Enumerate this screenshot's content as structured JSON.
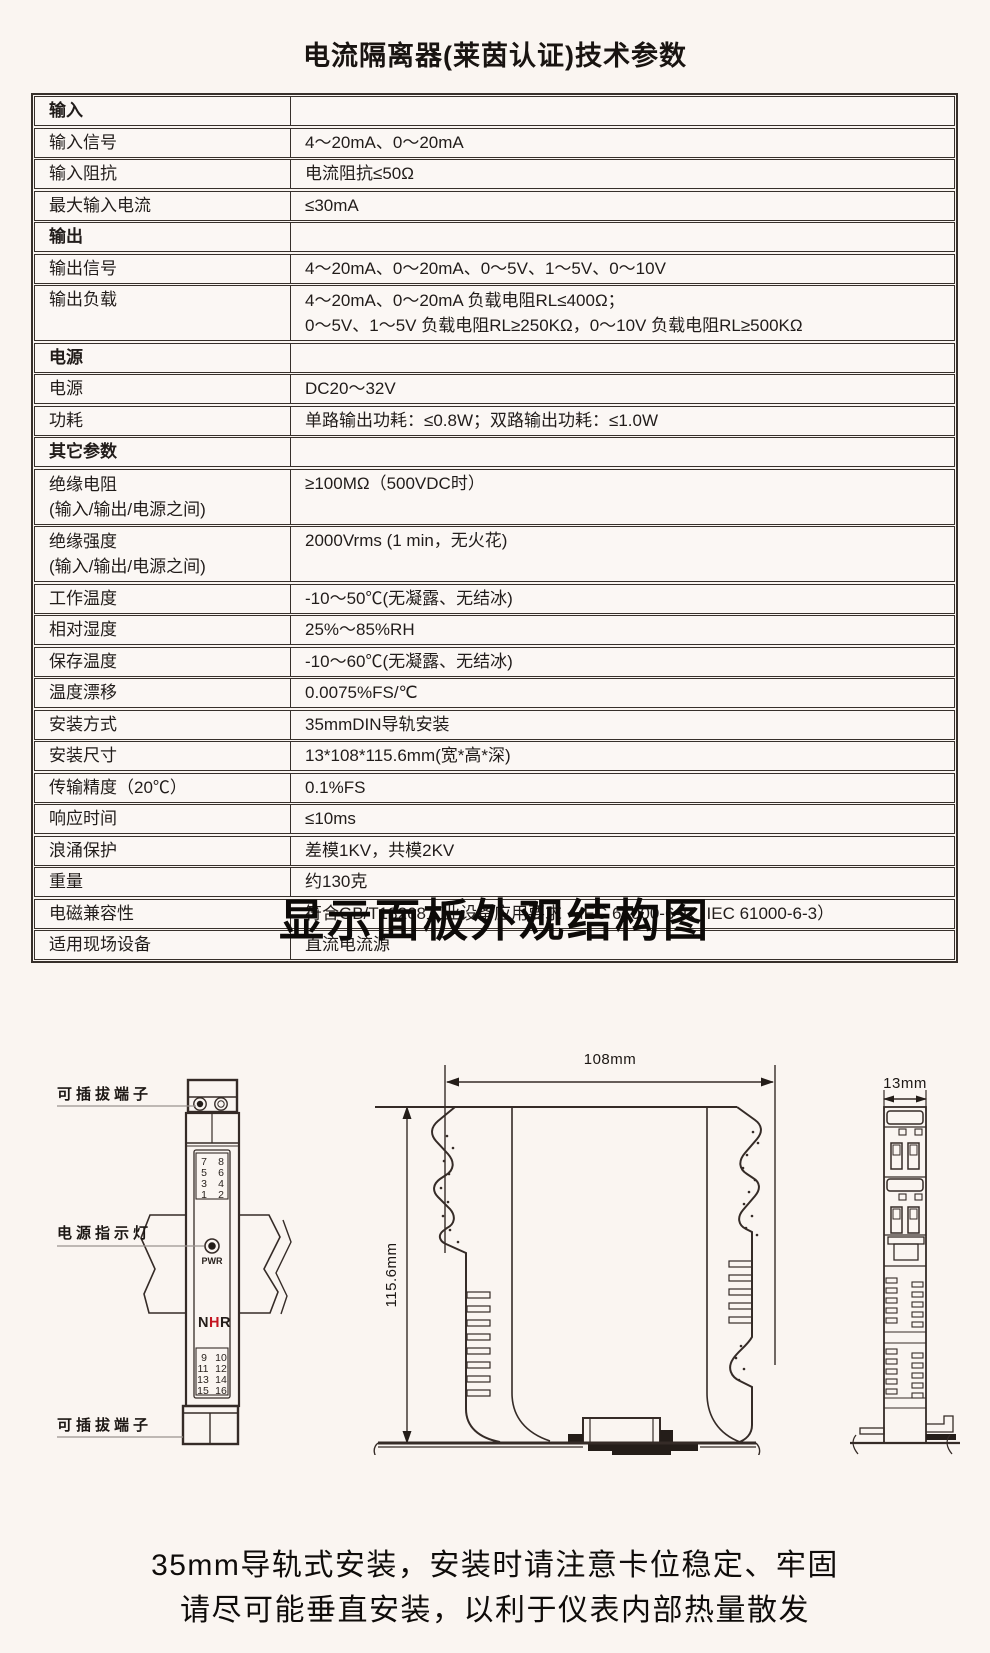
{
  "page": {
    "colors": {
      "background": "#faf5f1",
      "table_border": "#37302b",
      "drawing_line": "#352b27",
      "text": "#211c1a",
      "brand_red": "#c41420"
    }
  },
  "spec": {
    "title": "电流隔离器(莱茵认证)技术参数",
    "rows": [
      {
        "section": true,
        "label": "输入",
        "value": ""
      },
      {
        "label": "输入信号",
        "value": "4～20mA、0～20mA"
      },
      {
        "label": "输入阻抗",
        "value": "电流阻抗≤50Ω"
      },
      {
        "label": "最大输入电流",
        "value": "≤30mA"
      },
      {
        "section": true,
        "label": "输出",
        "value": ""
      },
      {
        "label": "输出信号",
        "value": "4～20mA、0～20mA、0～5V、1～5V、0～10V"
      },
      {
        "label": "输出负载",
        "value": [
          "4～20mA、0～20mA 负载电阻RL≤400Ω；",
          "0～5V、1～5V 负载电阻RL≥250KΩ，0～10V 负载电阻RL≥500KΩ"
        ]
      },
      {
        "section": true,
        "label": "电源",
        "value": ""
      },
      {
        "label": "电源",
        "value": "DC20～32V"
      },
      {
        "label": "功耗",
        "value": "单路输出功耗：≤0.8W；双路输出功耗：≤1.0W"
      },
      {
        "section": true,
        "label": "其它参数",
        "value": ""
      },
      {
        "label": [
          "绝缘电阻",
          "(输入/输出/电源之间)"
        ],
        "value": "≥100MΩ（500VDC时）"
      },
      {
        "label": [
          "绝缘强度",
          "(输入/输出/电源之间)"
        ],
        "value": "2000Vrms (1 min，无火花)"
      },
      {
        "label": "工作温度",
        "value": "-10～50℃(无凝露、无结冰)"
      },
      {
        "label": "相对湿度",
        "value": "25%～85%RH"
      },
      {
        "label": "保存温度",
        "value": "-10～60℃(无凝露、无结冰)"
      },
      {
        "label": "温度漂移",
        "value": "0.0075%FS/℃"
      },
      {
        "label": "安装方式",
        "value": "35mmDIN导轨安装"
      },
      {
        "label": "安装尺寸",
        "value": "13*108*115.6mm(宽*高*深)"
      },
      {
        "label": "传输精度（20℃）",
        "value": "0.1%FS"
      },
      {
        "label": "响应时间",
        "value": "≤10ms"
      },
      {
        "label": "浪涌保护",
        "value": "差模1KV，共模2KV"
      },
      {
        "label": "重量",
        "value": "约130克"
      },
      {
        "label": "电磁兼容性",
        "value": "符合GB/T18268工业设备应用要求（IEC 61000-6-1、IEC 61000-6-3）"
      },
      {
        "label": "适用现场设备",
        "value": "直流电流源"
      }
    ]
  },
  "structure": {
    "title": "显示面板外观结构图",
    "front_view": {
      "label_top_terminal": "可插拔端子",
      "label_power_led": "电源指示灯",
      "label_bottom_terminal": "可插拔端子",
      "pwr_label": "PWR",
      "brand": {
        "n": "N",
        "h": "H",
        "r": "R"
      },
      "terminals_top": [
        "7",
        "8",
        "5",
        "6",
        "3",
        "4",
        "1",
        "2"
      ],
      "terminals_bottom": [
        "9",
        "10",
        "11",
        "12",
        "13",
        "14",
        "15",
        "16"
      ]
    },
    "side_view": {
      "width_dim": "108mm",
      "height_dim": "115.6mm"
    },
    "top_view": {
      "width_dim": "13mm"
    }
  },
  "footer": {
    "lines": [
      "35mm导轨式安装，安装时请注意卡位稳定、牢固",
      "请尽可能垂直安装，以利于仪表内部热量散发"
    ]
  }
}
